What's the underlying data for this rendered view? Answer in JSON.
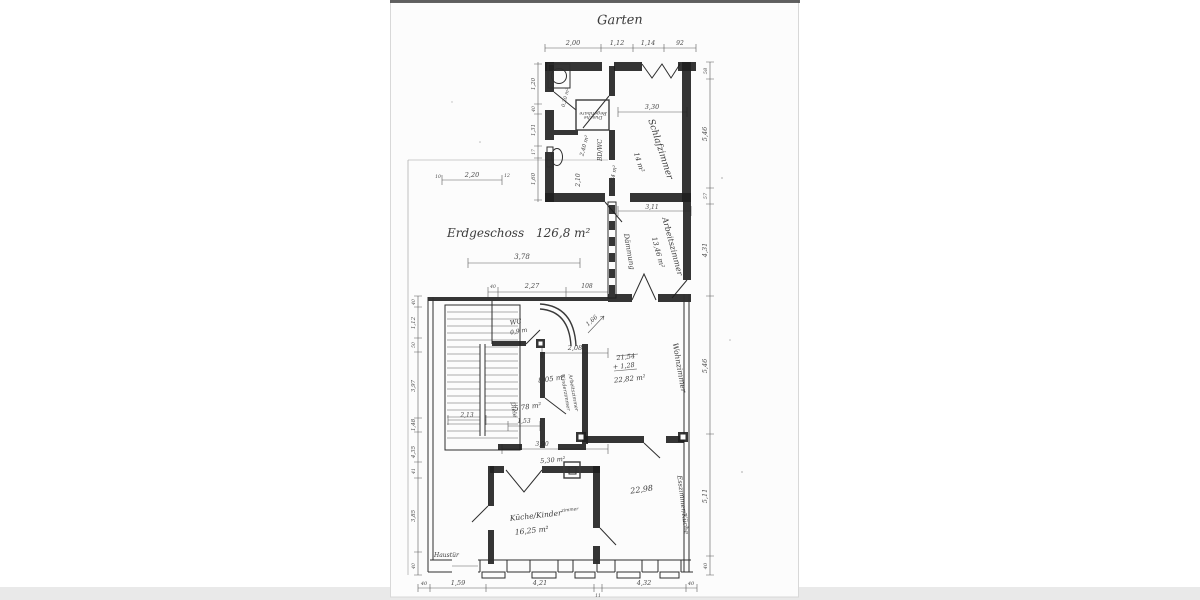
{
  "page": {
    "background": "#ffffff",
    "paper_color": "#fcfcfc",
    "scan_band_color": "#e9e9e9",
    "ink_color": "#1f1f1f"
  },
  "labels": {
    "garten": "Garten",
    "floor": "Erdgeschoss",
    "floor_area": "126,8 m²",
    "haustuer": "Haustür"
  },
  "rooms": {
    "schlafzimmer": {
      "name": "Schlafzimmer",
      "area": "14 m²"
    },
    "dusche": {
      "line1": "Begehbare",
      "line2": "Dusche",
      "area": "2,40 m²"
    },
    "bdwc": {
      "name": "BD/WC",
      "area": "3,34 m²"
    },
    "abstell": {
      "area": "0,20 m²"
    },
    "daemmung": {
      "name": "Dämmung"
    },
    "arbeitszimmer": {
      "name": "Arbeitszimmer",
      "area": "13,46 m²"
    },
    "wohnzimmer": {
      "name": "Wohnzimmer",
      "calc_top": "21,54",
      "calc_add": "+ 1,28",
      "area": "22,82 m²"
    },
    "kinder_arbeits": {
      "line1": "Kinderzimmer",
      "line2": "Arbeitszimmer",
      "area": "8,05 m²"
    },
    "wc": {
      "name": "WC",
      "area": "0,9 m"
    },
    "diele": {
      "name": "Diele",
      "area": "5,78 m²"
    },
    "flur": {
      "area": "5,30 m²"
    },
    "kueche": {
      "name": "Küche/Kinder",
      "name_sup": "zimmer",
      "area": "16,25 m²"
    },
    "esszimmer": {
      "name": "Esszimmer/Küche",
      "area": "22,98"
    }
  },
  "dims": {
    "annex_top": [
      "2,00",
      "1,12",
      "1,14",
      "92"
    ],
    "annex_left": [
      "1,20",
      "40",
      "1,31",
      "17",
      "1,60"
    ],
    "right_chain": [
      "58",
      "5,46",
      "57",
      "4,31",
      "5,46",
      "5,11",
      "40"
    ],
    "left_chain": [
      "40",
      "1,12",
      "50",
      "3,97",
      "1,48",
      "4,35",
      "41",
      "3,85",
      "40"
    ],
    "bottom_chain": [
      "40",
      "1,59",
      "4,21",
      "11",
      "4,32",
      "40"
    ],
    "top_small": {
      "left": "10",
      "value": "2,20",
      "right": "12"
    },
    "mid_row": [
      "40",
      "2,27",
      "108"
    ],
    "inner": {
      "d330": "3,30",
      "d311": "3,11",
      "d210": "2,10",
      "d378": "3,78",
      "d208": "2,08",
      "d213": "2,13",
      "d153": "1,53",
      "d390": "3,90",
      "d166": "1,66"
    }
  }
}
